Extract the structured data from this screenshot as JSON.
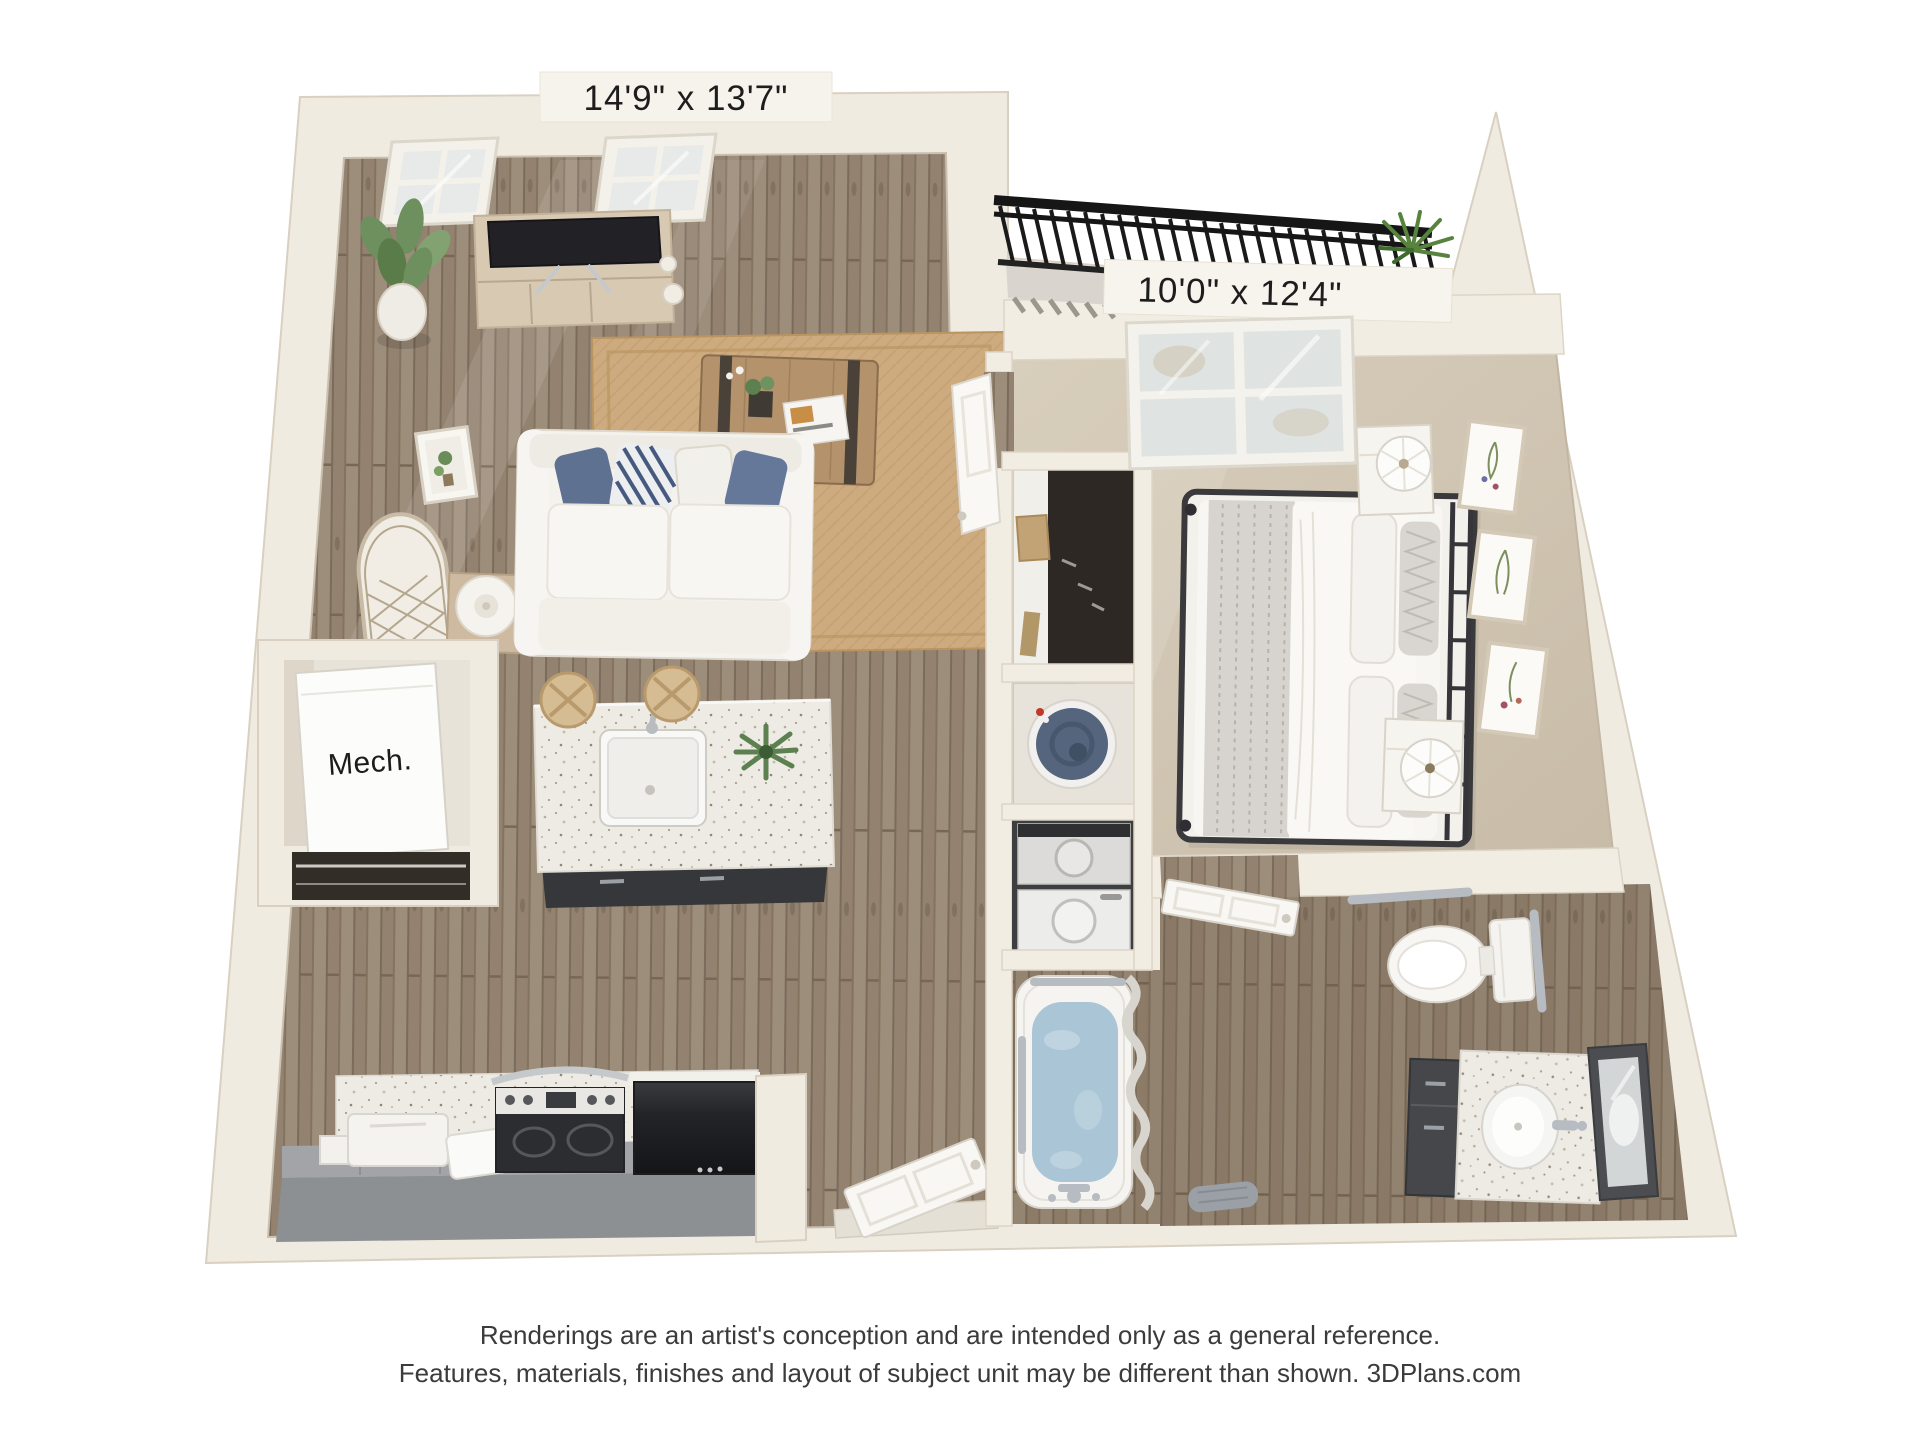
{
  "page": {
    "background_color": "#ffffff"
  },
  "floor_plan": {
    "living_room": {
      "dimensions_label": "14'9\" x 13'7\""
    },
    "bedroom": {
      "dimensions_label": "10'0\" x 12'4\""
    },
    "mechanical_closet": {
      "label": "Mech."
    },
    "colors": {
      "wall": "#f0ebe1",
      "wall_edge": "#d9d0c1",
      "wood_floor_base": "#93826f",
      "carpet": "#d3c8b6",
      "rug": "#cdab7e",
      "island_counter": "#edebe4",
      "cabinet_dark": "#35373b",
      "kitchen_counter_gray": "#8d9093",
      "appliance_black": "#232427",
      "bathtub_water": "#aac6d6",
      "water_heater_navy": "#54657d",
      "railing_black": "#1a1a1a",
      "plant_green": "#5d8050",
      "label_text": "#1d1d1d",
      "footer_text": "#3b3b3b"
    }
  },
  "footer": {
    "line1": "Renderings are an artist's conception and are intended only as a general reference.",
    "line2": "Features, materials, finishes and layout of subject unit may be different than shown. 3DPlans.com"
  }
}
